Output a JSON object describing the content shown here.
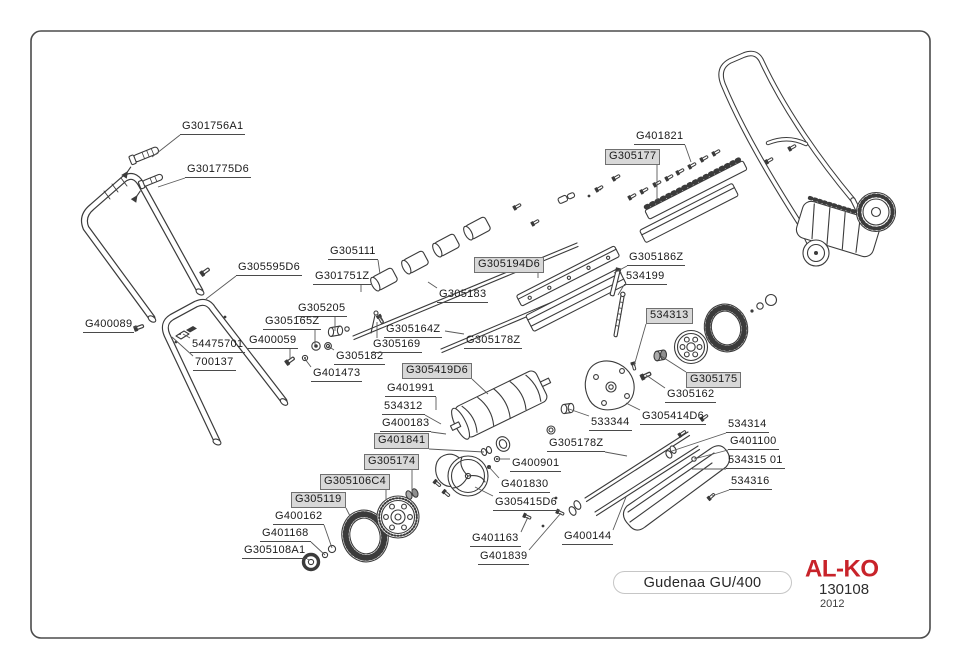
{
  "diagram": {
    "border_color": "#4b4b4b",
    "line_color": "#3b3b3b",
    "boxed_label_bg": "#d8d8d8",
    "labels": [
      {
        "text": "G301756A1",
        "x": 180,
        "y": 120,
        "boxed": false,
        "tx": 152,
        "ty": 157
      },
      {
        "text": "G301775D6",
        "x": 185,
        "y": 163,
        "boxed": false,
        "tx": 158,
        "ty": 187
      },
      {
        "text": "G305595D6",
        "x": 236,
        "y": 261,
        "boxed": false,
        "tx": 206,
        "ty": 299
      },
      {
        "text": "G400089",
        "x": 83,
        "y": 318,
        "boxed": false,
        "tx": 137,
        "ty": 327
      },
      {
        "text": "54475701",
        "x": 190,
        "y": 338,
        "boxed": false,
        "tx": 183,
        "ty": 334
      },
      {
        "text": "700137",
        "x": 193,
        "y": 356,
        "boxed": false,
        "tx": 172,
        "ty": 337
      },
      {
        "text": "G305205",
        "x": 296,
        "y": 302,
        "boxed": false,
        "tx": 335,
        "ty": 331
      },
      {
        "text": "G305165Z",
        "x": 263,
        "y": 315,
        "boxed": false,
        "tx": 315,
        "ty": 345
      },
      {
        "text": "G400059",
        "x": 247,
        "y": 334,
        "boxed": false,
        "tx": 290,
        "ty": 359
      },
      {
        "text": "G305182",
        "x": 334,
        "y": 350,
        "boxed": false,
        "tx": 328,
        "ty": 346
      },
      {
        "text": "G401473",
        "x": 311,
        "y": 367,
        "boxed": false,
        "tx": 305,
        "ty": 359
      },
      {
        "text": "G305111",
        "x": 328,
        "y": 245,
        "boxed": false,
        "tx": 380,
        "ty": 274
      },
      {
        "text": "G301751Z",
        "x": 313,
        "y": 270,
        "boxed": false,
        "tx": 361,
        "ty": 292
      },
      {
        "text": "G305183",
        "x": 437,
        "y": 288,
        "boxed": false,
        "tx": 428,
        "ty": 282
      },
      {
        "text": "G305164Z",
        "x": 384,
        "y": 323,
        "boxed": false,
        "tx": 378,
        "ty": 315
      },
      {
        "text": "G305169",
        "x": 371,
        "y": 338,
        "boxed": false,
        "tx": 377,
        "ty": 322
      },
      {
        "text": "G305194D6",
        "x": 474,
        "y": 257,
        "boxed": true,
        "tx": 538,
        "ty": 278
      },
      {
        "text": "G305178Z",
        "x": 464,
        "y": 334,
        "boxed": false,
        "tx": 445,
        "ty": 331
      },
      {
        "text": "G401821",
        "x": 634,
        "y": 130,
        "boxed": false,
        "tx": 691,
        "ty": 162
      },
      {
        "text": "G305177",
        "x": 605,
        "y": 149,
        "boxed": true,
        "tx": 657,
        "ty": 200
      },
      {
        "text": "G305186Z",
        "x": 627,
        "y": 251,
        "boxed": false,
        "tx": 614,
        "ty": 273
      },
      {
        "text": "534199",
        "x": 624,
        "y": 270,
        "boxed": false,
        "tx": 618,
        "ty": 295
      },
      {
        "text": "534313",
        "x": 646,
        "y": 308,
        "boxed": true,
        "tx": 634,
        "ty": 366
      },
      {
        "text": "G305175",
        "x": 686,
        "y": 372,
        "boxed": true,
        "tx": 661,
        "ty": 356
      },
      {
        "text": "G305162",
        "x": 665,
        "y": 388,
        "boxed": false,
        "tx": 646,
        "ty": 375
      },
      {
        "text": "G305414D6",
        "x": 640,
        "y": 410,
        "boxed": false,
        "tx": 626,
        "ty": 403
      },
      {
        "text": "533344",
        "x": 589,
        "y": 416,
        "boxed": false,
        "tx": 569,
        "ty": 409
      },
      {
        "text": "G305419D6",
        "x": 402,
        "y": 363,
        "boxed": true,
        "tx": 488,
        "ty": 394
      },
      {
        "text": "G401991",
        "x": 385,
        "y": 382,
        "boxed": false,
        "tx": 436,
        "ty": 410
      },
      {
        "text": "534312",
        "x": 382,
        "y": 400,
        "boxed": false,
        "tx": 441,
        "ty": 424
      },
      {
        "text": "G400183",
        "x": 380,
        "y": 417,
        "boxed": false,
        "tx": 446,
        "ty": 434
      },
      {
        "text": "G401841",
        "x": 374,
        "y": 433,
        "boxed": true,
        "tx": 484,
        "ty": 452
      },
      {
        "text": "G305178Z",
        "x": 547,
        "y": 437,
        "boxed": false,
        "tx": 627,
        "ty": 456
      },
      {
        "text": "534314",
        "x": 726,
        "y": 418,
        "boxed": false,
        "tx": 672,
        "ty": 451
      },
      {
        "text": "G401100",
        "x": 728,
        "y": 435,
        "boxed": false,
        "tx": 694,
        "ty": 459
      },
      {
        "text": "534315 01",
        "x": 726,
        "y": 454,
        "boxed": false,
        "tx": 692,
        "ty": 469
      },
      {
        "text": "534316",
        "x": 729,
        "y": 475,
        "boxed": false,
        "tx": 712,
        "ty": 496
      },
      {
        "text": "G305174",
        "x": 364,
        "y": 454,
        "boxed": true,
        "tx": 412,
        "ty": 493
      },
      {
        "text": "G305106C4",
        "x": 320,
        "y": 474,
        "boxed": true,
        "tx": 386,
        "ty": 500
      },
      {
        "text": "G305119",
        "x": 291,
        "y": 492,
        "boxed": true,
        "tx": 350,
        "ty": 516
      },
      {
        "text": "G400162",
        "x": 273,
        "y": 510,
        "boxed": false,
        "tx": 332,
        "ty": 548
      },
      {
        "text": "G401168",
        "x": 260,
        "y": 527,
        "boxed": false,
        "tx": 325,
        "ty": 555
      },
      {
        "text": "G305108A1",
        "x": 242,
        "y": 544,
        "boxed": false,
        "tx": 310,
        "ty": 560
      },
      {
        "text": "G400901",
        "x": 510,
        "y": 457,
        "boxed": false,
        "tx": 497,
        "ty": 459
      },
      {
        "text": "G401830",
        "x": 499,
        "y": 478,
        "boxed": false,
        "tx": 489,
        "ty": 467
      },
      {
        "text": "G305415D6",
        "x": 493,
        "y": 496,
        "boxed": false,
        "tx": 475,
        "ty": 487
      },
      {
        "text": "G401163",
        "x": 470,
        "y": 532,
        "boxed": false,
        "tx": 528,
        "ty": 517
      },
      {
        "text": "G401839",
        "x": 478,
        "y": 550,
        "boxed": false,
        "tx": 561,
        "ty": 513
      },
      {
        "text": "G400144",
        "x": 562,
        "y": 530,
        "boxed": false,
        "tx": 626,
        "ty": 497
      }
    ]
  },
  "footer": {
    "model_label": "Gudenaa GU/400",
    "brand": "AL-KO",
    "brand_color": "#c8232a",
    "doc_number": "130108",
    "year": "2012"
  }
}
